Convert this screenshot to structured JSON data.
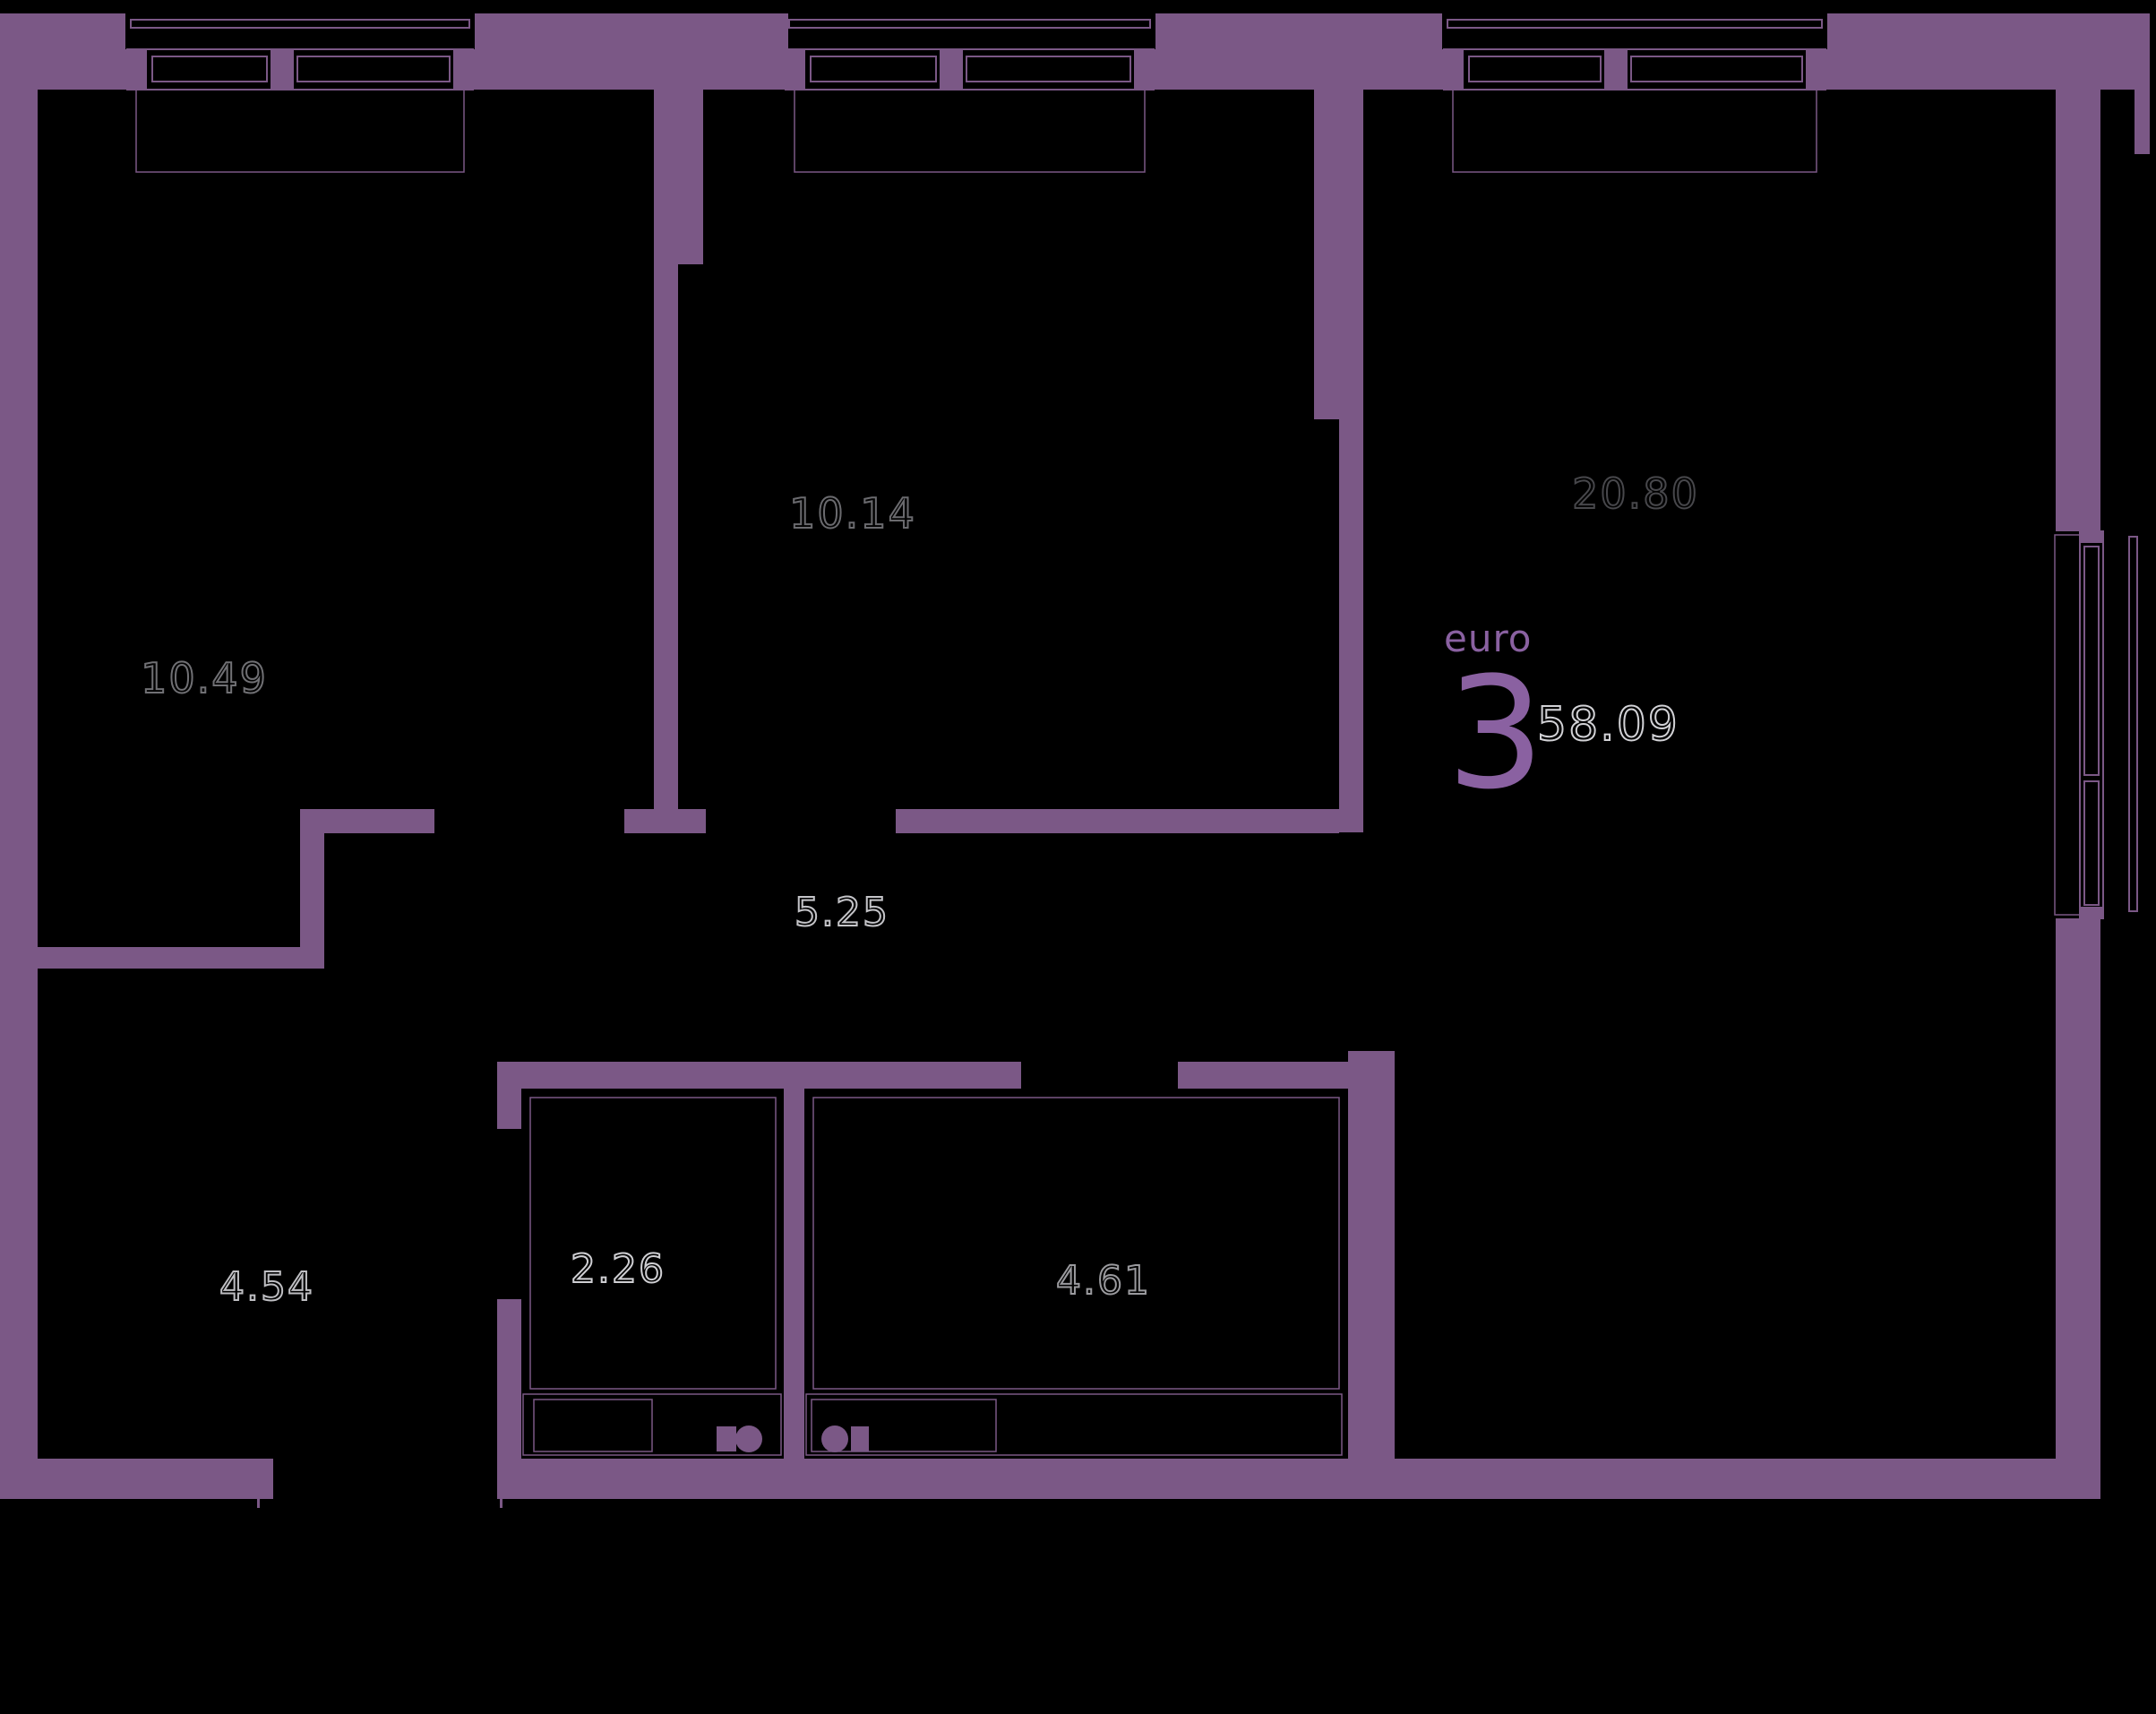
{
  "palette": {
    "background": "#000000",
    "wall": "#7b5886",
    "accent": "#8a61a1",
    "frame_line": "#7b5886"
  },
  "unit_badge": {
    "plan_type_label": "euro",
    "rooms_count": "3",
    "total_area": "58.09",
    "total_area_color": "#d2d2d6"
  },
  "rooms": [
    {
      "name": "bedroom-1",
      "area": "10.49",
      "label_color": "#707074"
    },
    {
      "name": "bedroom-2",
      "area": "10.14",
      "label_color": "#6a6a6e"
    },
    {
      "name": "living-room-kitchen",
      "area": "20.80",
      "label_color": "#47474b"
    },
    {
      "name": "corridor",
      "area": "5.25",
      "label_color": "#c4c4c8"
    },
    {
      "name": "water-closet",
      "area": "2.26",
      "label_color": "#cfcfd3"
    },
    {
      "name": "bathroom",
      "area": "4.61",
      "label_color": "#9a9a9e"
    },
    {
      "name": "entry-hall",
      "area": "4.54",
      "label_color": "#bebec2"
    }
  ]
}
